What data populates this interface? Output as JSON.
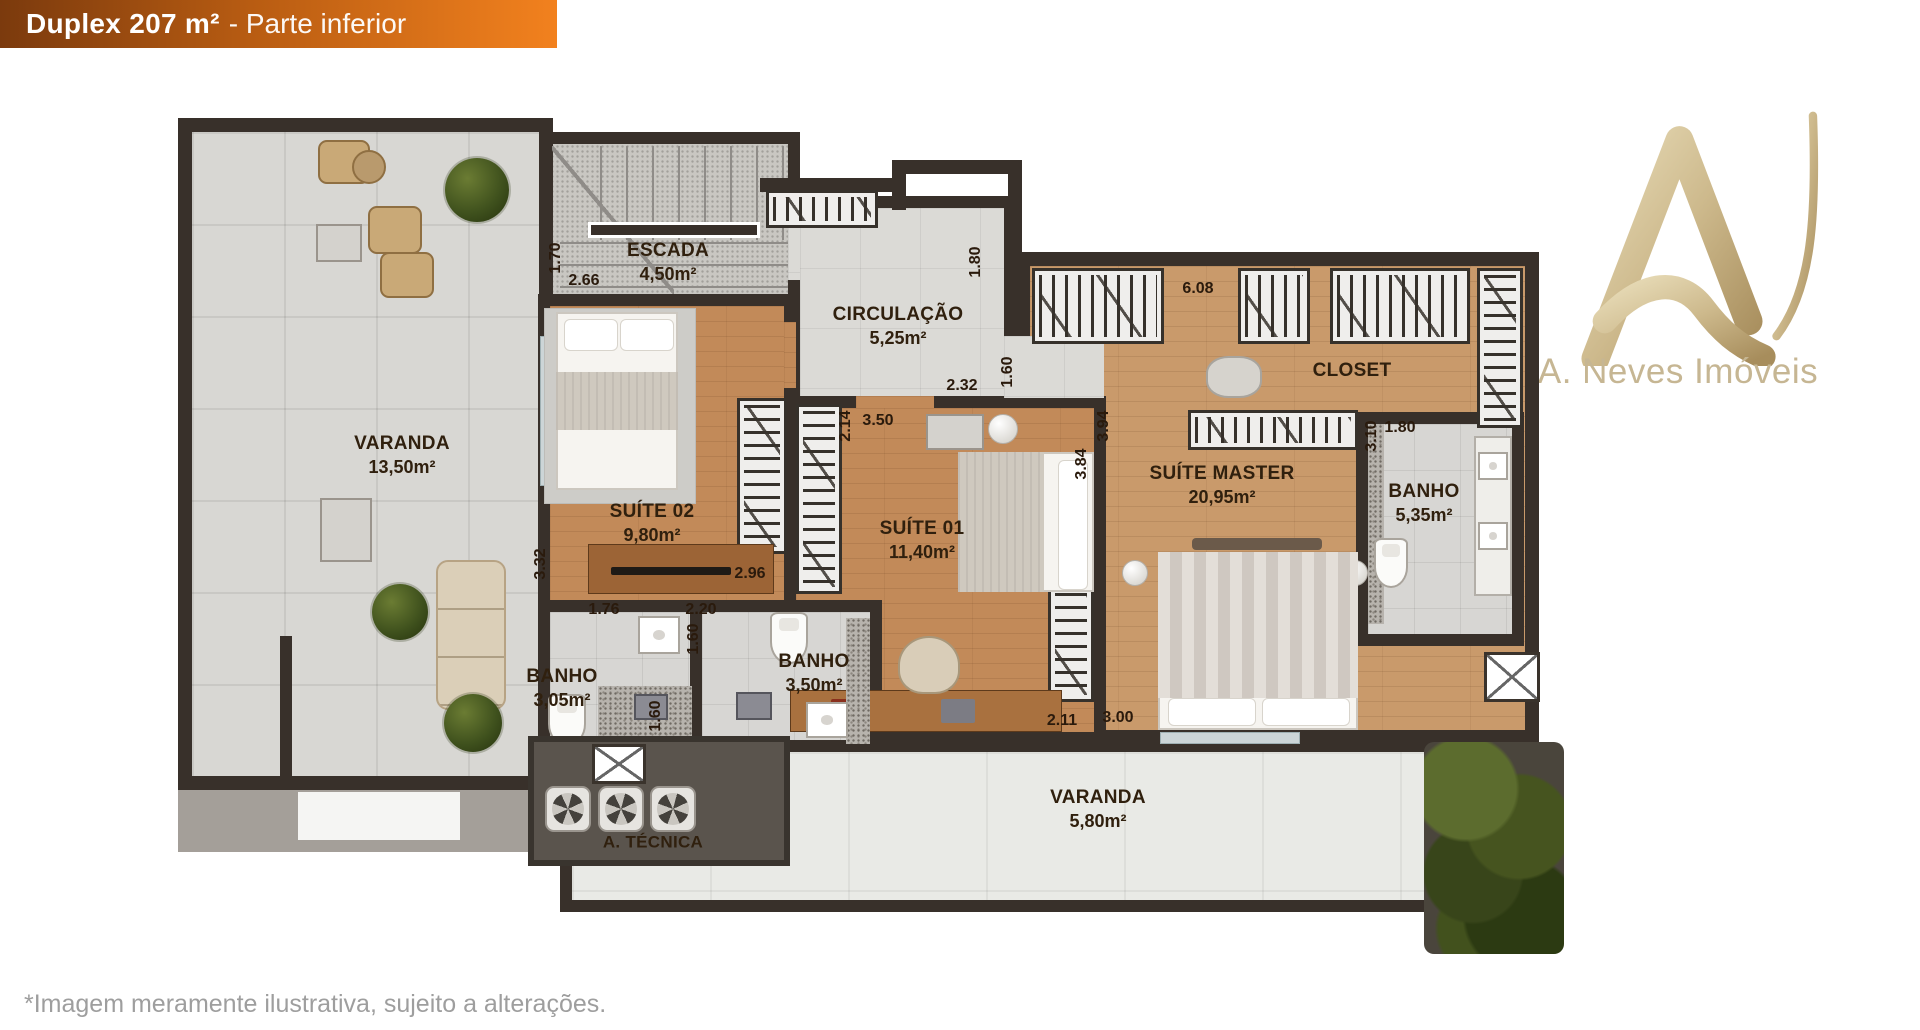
{
  "banner": {
    "title": "Duplex 207 m²",
    "subtitle": "- Parte inferior"
  },
  "logo": {
    "brand": "A. Neves Imóveis"
  },
  "footer": {
    "disclaimer": "*Imagem meramente ilustrativa, sujeito a alterações."
  },
  "rooms": {
    "varanda_left": {
      "name": "VARANDA",
      "area": "13,50m²"
    },
    "escada": {
      "name": "ESCADA",
      "area": "4,50m²"
    },
    "circulacao": {
      "name": "CIRCULAÇÃO",
      "area": "5,25m²"
    },
    "suite02": {
      "name": "SUÍTE 02",
      "area": "9,80m²"
    },
    "suite01": {
      "name": "SUÍTE 01",
      "area": "11,40m²"
    },
    "suite_master": {
      "name": "SUÍTE MASTER",
      "area": "20,95m²"
    },
    "closet": {
      "name": "CLOSET"
    },
    "banho_master": {
      "name": "BANHO",
      "area": "5,35m²"
    },
    "banho_suite02": {
      "name": "BANHO",
      "area": "3,05m²"
    },
    "banho_suite01": {
      "name": "BANHO",
      "area": "3,50m²"
    },
    "varanda_inferior": {
      "name": "VARANDA",
      "area": "5,80m²"
    },
    "area_tecnica": {
      "name": "A. TÉCNICA"
    }
  },
  "dims": {
    "escada_h": "1.70",
    "escada_w": "2.66",
    "circ_h": "1.80",
    "circ_w": "2.32",
    "corredor_h": "1.60",
    "closet_w": "6.08",
    "suite01_door_h": "2.14",
    "suite01_top_w": "3.50",
    "master_left_h": "3.94",
    "suite01_h": "3.84",
    "suite02_h": "3.32",
    "suite02_w": "2.96",
    "banho02_w": "1.76",
    "banho02_h": "1.60",
    "banho01_w": "2.20",
    "banho01_h": "1.60",
    "suite01_bottom_w": "2.11",
    "master_bottom_w": "3.00",
    "banho_master_h": "3.10",
    "banho_master_w": "1.80"
  },
  "colors": {
    "banner_gradient_start": "#7b3a0d",
    "banner_gradient_end": "#f2811e",
    "wall": "#38302a",
    "wood_floor": "#c28a59",
    "bath_tile": "#d7d6d3",
    "logo_gold": "#c6b693",
    "label_text": "#30200e"
  }
}
